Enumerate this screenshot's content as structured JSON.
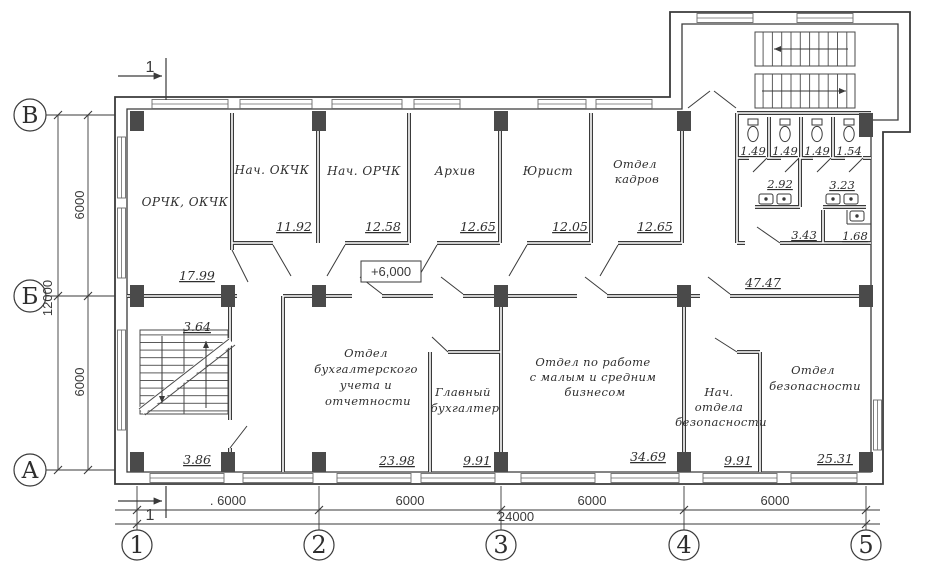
{
  "colors": {
    "ink": "#3a3a3a",
    "paper": "#ffffff",
    "column_fill": "#4a4a4a"
  },
  "axis": {
    "rows": [
      {
        "label": "В"
      },
      {
        "label": "Б"
      },
      {
        "label": "А"
      }
    ],
    "cols": [
      {
        "label": "1"
      },
      {
        "label": "2"
      },
      {
        "label": "3"
      },
      {
        "label": "4"
      },
      {
        "label": "5"
      }
    ]
  },
  "dims": {
    "left": {
      "upper": "6000",
      "lower": "6000",
      "total": "12000"
    },
    "bottom": {
      "spans": [
        ". 6000",
        "6000",
        "6000",
        "6000"
      ],
      "total": "24000"
    }
  },
  "section_mark": {
    "top": "1",
    "bottom": "1"
  },
  "elevation_mark": "+6,000",
  "corridor": {
    "area": "47.47"
  },
  "rooms": [
    {
      "id": "orchk",
      "lines": [
        "ОРЧК, ОКЧК"
      ],
      "area": "17.99"
    },
    {
      "id": "nach-okchk",
      "lines": [
        "Нач. ОКЧК"
      ],
      "area": "11.92"
    },
    {
      "id": "nach-orchk",
      "lines": [
        "Нач. ОРЧК"
      ],
      "area": "12.58"
    },
    {
      "id": "arhiv",
      "lines": [
        "Архив"
      ],
      "area": "12.65"
    },
    {
      "id": "yurist",
      "lines": [
        "Юрист"
      ],
      "area": "12.05"
    },
    {
      "id": "otdel-kadrov",
      "lines": [
        "Отдел",
        "кадров"
      ],
      "area": "12.65"
    },
    {
      "id": "buhgalteria",
      "lines": [
        "Отдел",
        "бухгалтерского",
        "учета и",
        "отчетности"
      ],
      "area": "23.98"
    },
    {
      "id": "glavbuh",
      "lines": [
        "Главный",
        "бухгалтер"
      ],
      "area": "9.91"
    },
    {
      "id": "malyi-biznes",
      "lines": [
        "Отдел по работе",
        "с малым и средним",
        "бизнесом"
      ],
      "area": "34.69"
    },
    {
      "id": "nach-bezopasnosti",
      "lines": [
        "Нач.",
        "отдела",
        "безопасности"
      ],
      "area": "9.91"
    },
    {
      "id": "bezopasnost",
      "lines": [
        "Отдел",
        "безопасности"
      ],
      "area": "25.31"
    }
  ],
  "sanitary": {
    "wc_stalls": [
      "1.49",
      "1.49",
      "1.49",
      "1.54"
    ],
    "washrooms": [
      "2.92",
      "3.23"
    ],
    "lobbies": [
      "3.43",
      "1.68"
    ]
  },
  "stairs": {
    "upper_area": "3.64",
    "lower_area": "3.86"
  }
}
